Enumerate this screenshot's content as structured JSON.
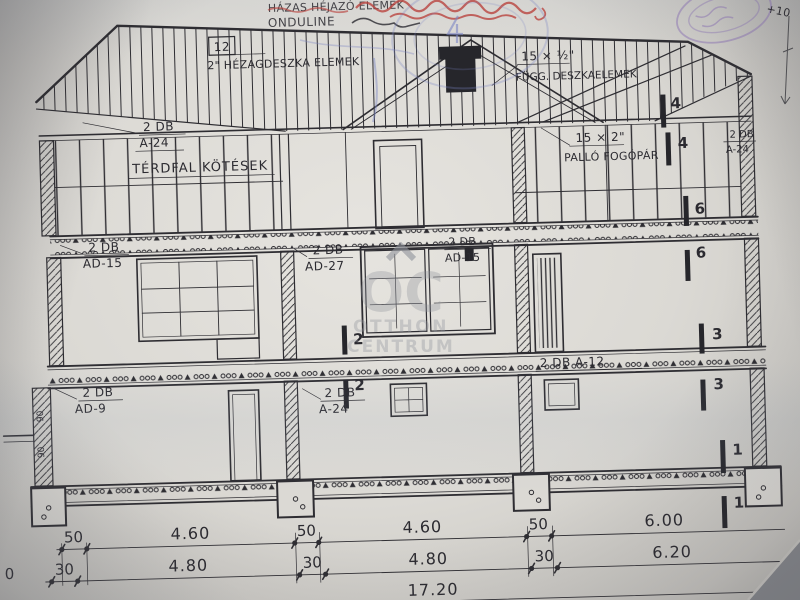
{
  "annotations": {
    "pencil_line1": "HÁZAS HÉJAZÓ ELEMEK",
    "pencil_line2": "ONDULINE",
    "plus_note": "+10"
  },
  "watermark": {
    "logo": "OC",
    "line1": "OTTHON",
    "line2": "CENTRUM"
  },
  "labels": {
    "a24_top_l1": "2 DB",
    "a24_top_l2": "A-24",
    "terdfal": "TÉRDFAL KÖTÉSEK",
    "boxed12": "12",
    "hezag_note": "2\" HÉZAGDESZKA ELEMEK",
    "fur_l1": "15 × ½\"",
    "fur_l2": "FÜGG. DESZKAELEMEK",
    "pallo_l1": "15 × 2\"",
    "pallo_l2": "PALLÓ FOGÓPÁR",
    "a24_right_l1": "2 DB",
    "a24_right_l2": "A-24",
    "ad15_left_l1": "2 DB",
    "ad15_left_l2": "AD-15",
    "ad27_l1": "2 DB",
    "ad27_l2": "AD-27",
    "ad15_mid_l1": "2 DB",
    "ad15_mid_l2": "AD-15",
    "a12": "2 DB  A-12",
    "a24_low_l1": "2 DB",
    "a24_low_l2": "A-24",
    "ad9_l1": "2 DB",
    "ad9_l2": "AD-9",
    "wall_dim_a": "90",
    "wall_dim_b": "90"
  },
  "markers": {
    "k4a": "4",
    "k4b": "4",
    "k6a": "6",
    "k6b": "6",
    "k3a": "3",
    "k3b": "3",
    "k2a": "2",
    "k2b": "2",
    "k1a": "1",
    "k1b": "1"
  },
  "dimensions": {
    "row1": [
      "50",
      "4.60",
      "50",
      "4.60",
      "50",
      "6.00"
    ],
    "row2": [
      "30",
      "4.80",
      "30",
      "4.80",
      "30",
      "6.20"
    ],
    "total": "17.20",
    "edge_partial": "0"
  },
  "colors": {
    "ink": "#2e2d32",
    "paper": "#dbd9d4",
    "watermark_gray": "#8f939b",
    "stamp_red": "#b9413c",
    "stamp_blue": "#7b85c4",
    "stamp_purple": "#8d74b8"
  }
}
